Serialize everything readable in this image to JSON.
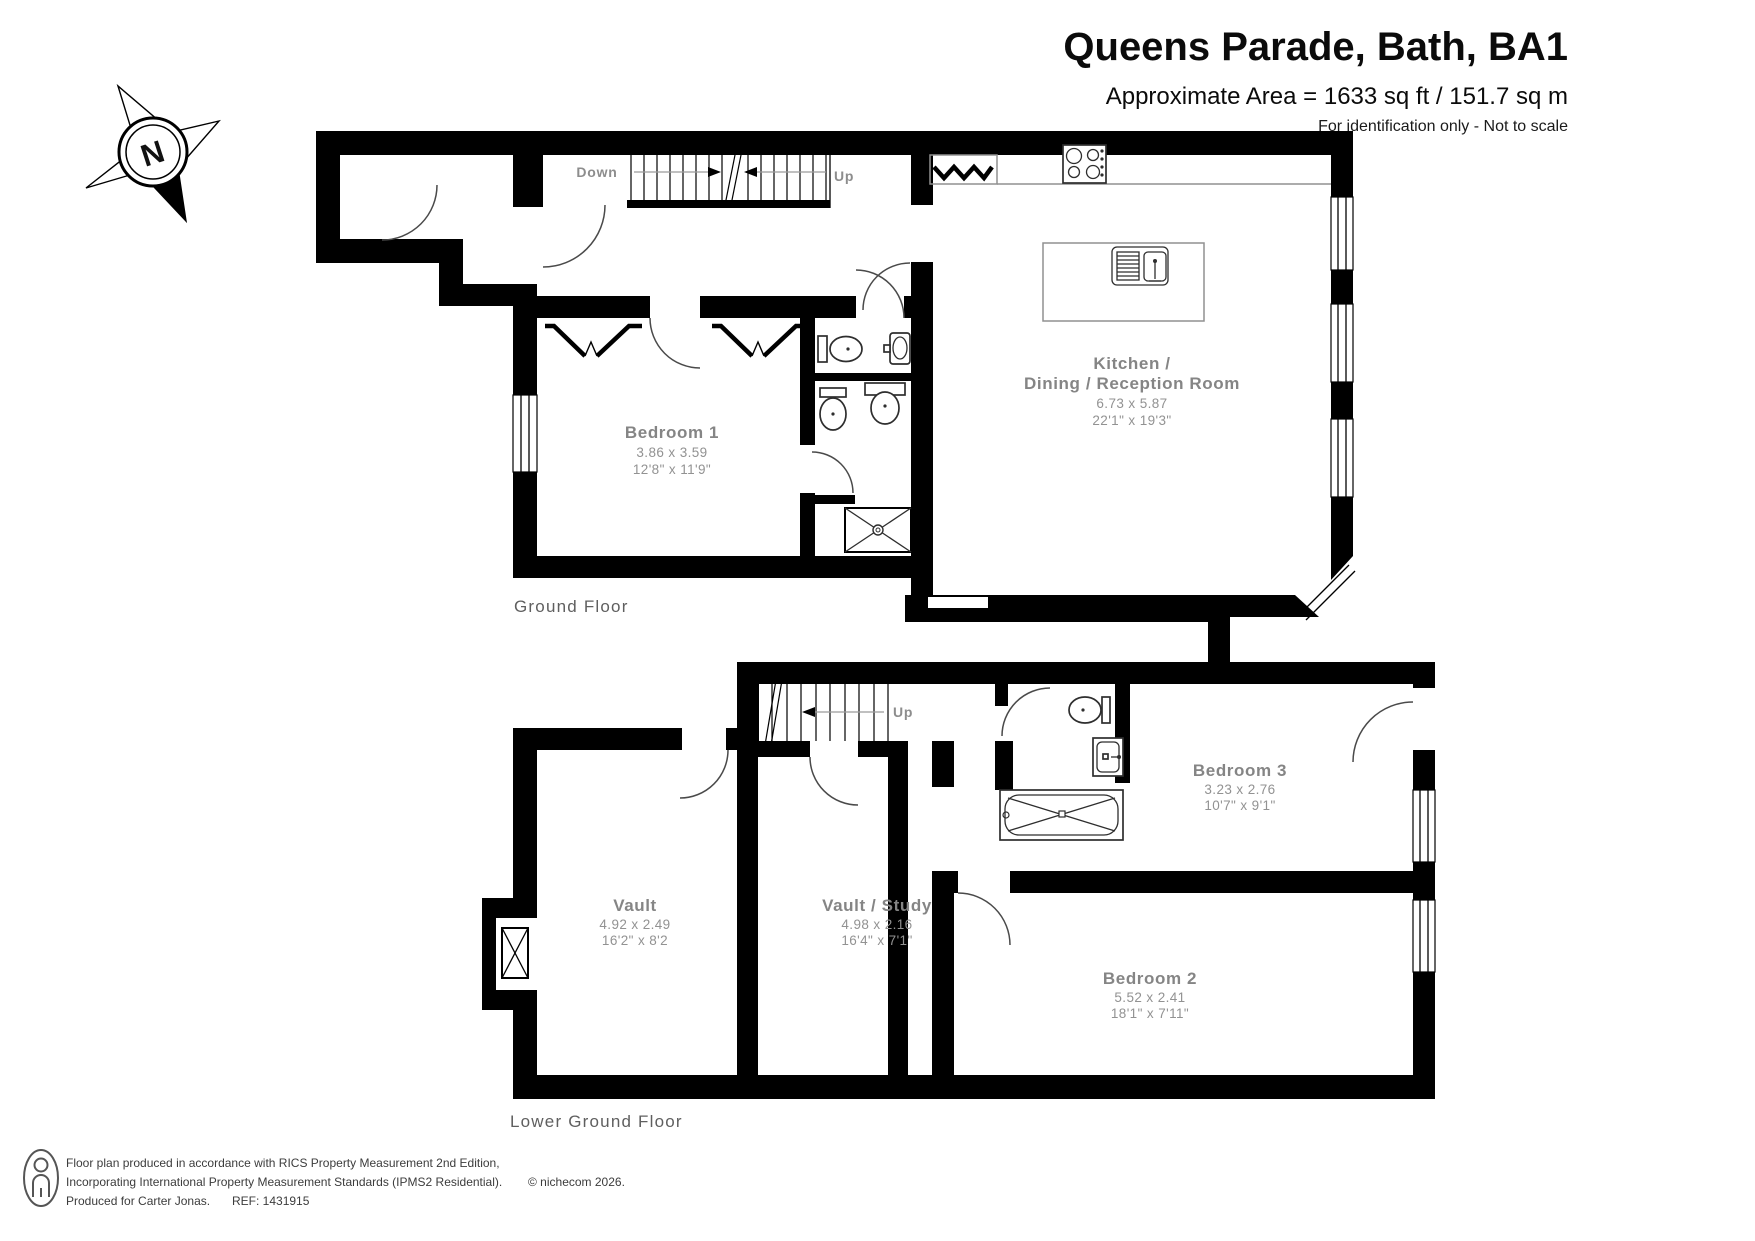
{
  "title": "Queens Parade, Bath, BA1",
  "area_line": "Approximate Area = 1633 sq ft / 151.7 sq m",
  "disclaimer": "For identification only - Not to scale",
  "compass": {
    "north_label": "N"
  },
  "floors": {
    "ground": {
      "label": "Ground Floor",
      "stairs": {
        "down_label": "Down",
        "up_label": "Up"
      },
      "rooms": {
        "bedroom1": {
          "name": "Bedroom 1",
          "dims_m": "3.86 x 3.59",
          "dims_ft": "12'8\" x 11'9\""
        },
        "kitchen": {
          "name_line1": "Kitchen /",
          "name_line2": "Dining / Reception Room",
          "dims_m": "6.73 x 5.87",
          "dims_ft": "22'1\" x 19'3\""
        }
      }
    },
    "lower": {
      "label": "Lower Ground Floor",
      "stairs": {
        "up_label": "Up"
      },
      "rooms": {
        "vault": {
          "name": "Vault",
          "dims_m": "4.92 x 2.49",
          "dims_ft": "16'2\" x 8'2"
        },
        "vault_study": {
          "name": "Vault / Study",
          "dims_m": "4.98 x 2.16",
          "dims_ft": "16'4\" x 7'1\""
        },
        "bedroom2": {
          "name": "Bedroom 2",
          "dims_m": "5.52 x 2.41",
          "dims_ft": "18'1\" x 7'11\""
        },
        "bedroom3": {
          "name": "Bedroom 3",
          "dims_m": "3.23 x 2.76",
          "dims_ft": "10'7\" x 9'1\""
        }
      }
    }
  },
  "footer": {
    "line1": "Floor plan produced in accordance with RICS Property Measurement 2nd Edition,",
    "line2": "Incorporating International Property Measurement Standards (IPMS2 Residential).",
    "copyright": "© nichecom 2026.",
    "line3_left": "Produced for Carter Jonas.",
    "line3_ref": "REF: 1431915"
  },
  "colors": {
    "wall": "#000000",
    "label_gray": "#858585",
    "fixture": "#2e2e2e"
  }
}
